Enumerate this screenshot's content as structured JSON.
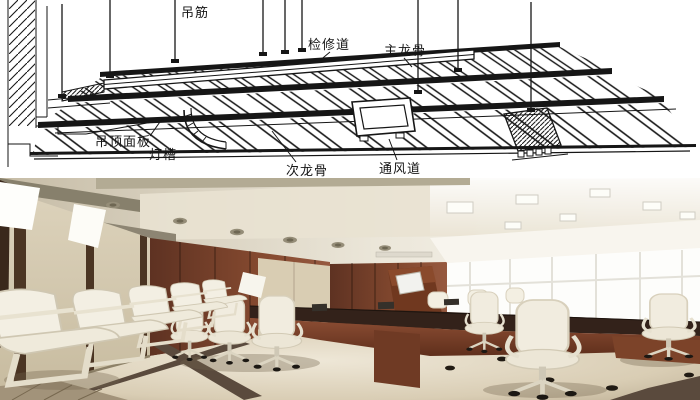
{
  "diagram": {
    "labels": {
      "hanger_rod": "吊筋",
      "access_walkway": "检修道",
      "main_runner": "主龙骨",
      "ceiling_panel": "吊顶面板",
      "light_cove": "灯槽",
      "secondary_runner": "次龙骨",
      "air_duct": "通风道"
    },
    "colors": {
      "ink": "#161616",
      "paper": "#ffffff"
    }
  },
  "photo": {
    "colors": {
      "beam_gray": "#87806c",
      "left_wall_beige": "#d6cbb2",
      "corner_beige": "#d9cdb3",
      "strip_brown": "#4b3523",
      "wood_wall": "#7a4630",
      "window_white": "#fdfdfb",
      "sill_cream": "#ecdfc8",
      "table_top": "#33221a",
      "table_wood": "#6f3a24",
      "lectern_wood": "#70381f",
      "chair_ivory": "#f3efe3",
      "accent_stripe": "#5a4a3d",
      "tile_band": "#a2937a",
      "outlet_black": "#211b14"
    }
  }
}
